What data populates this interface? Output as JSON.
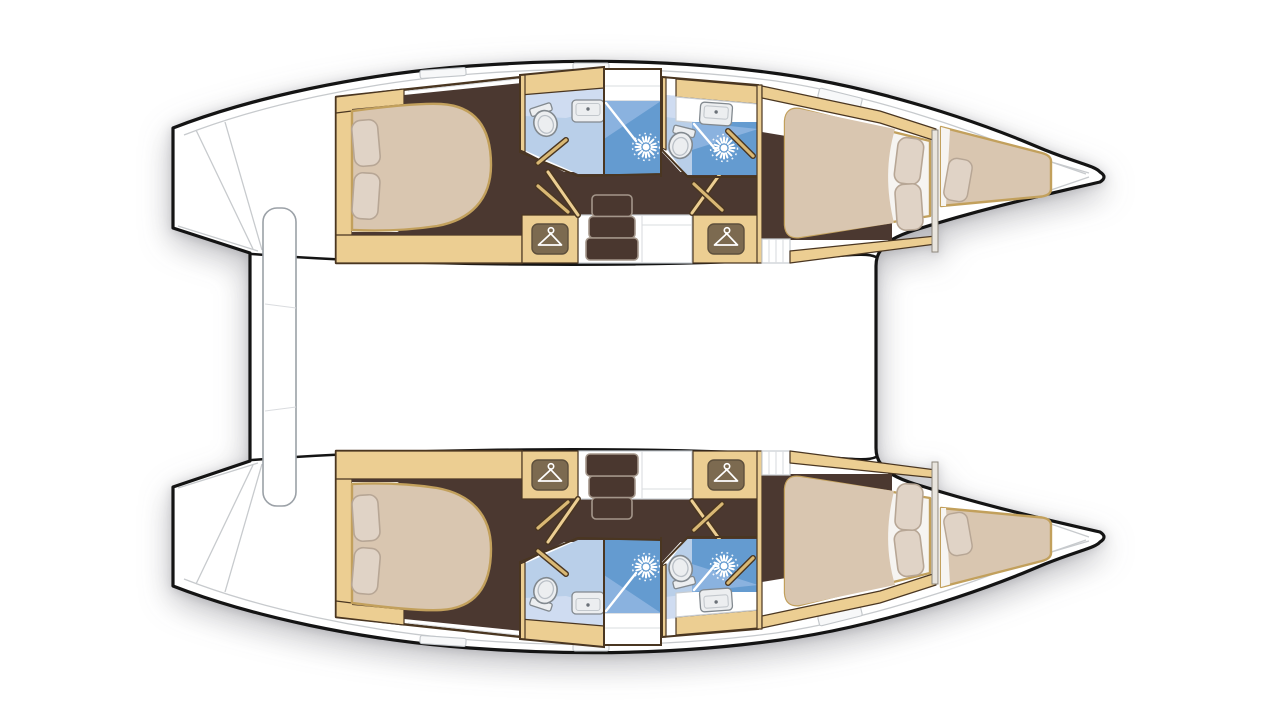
{
  "vessel": {
    "title": "Catamaran interior layout — deck plan, top view",
    "type": "catamaran sailing yacht floor plan",
    "configuration": "4 double cabins, 4 shower rooms, 2 forepeak berths",
    "hull_count": 2,
    "orientation": "bow to the right, boarding steps to the left"
  },
  "hulls": [
    {
      "id": "port-hull",
      "position": "top",
      "sections": [
        {
          "name": "aft cabin",
          "furniture": [
            "island double bed",
            "two pillows",
            "side cabinets"
          ]
        },
        {
          "name": "aft shower room",
          "fixtures": [
            "toilet",
            "washbasin",
            "shower with drain"
          ]
        },
        {
          "name": "forward shower room",
          "fixtures": [
            "toilet",
            "washbasin",
            "shower with drain"
          ]
        },
        {
          "name": "companionway",
          "features": [
            "three-step staircase",
            "two hanging wardrobes"
          ]
        },
        {
          "name": "forward cabin",
          "furniture": [
            "double bed",
            "two pillows",
            "entry steps"
          ]
        },
        {
          "name": "forepeak berth",
          "furniture": [
            "single mattress",
            "one pillow"
          ]
        },
        {
          "name": "transom",
          "features": [
            "boarding steps"
          ]
        }
      ]
    },
    {
      "id": "starboard-hull",
      "position": "bottom",
      "sections": [
        {
          "name": "aft cabin",
          "furniture": [
            "island double bed",
            "two pillows",
            "side cabinets"
          ]
        },
        {
          "name": "aft shower room",
          "fixtures": [
            "toilet",
            "washbasin",
            "shower with drain"
          ]
        },
        {
          "name": "forward shower room",
          "fixtures": [
            "toilet",
            "washbasin",
            "shower with drain"
          ]
        },
        {
          "name": "companionway",
          "features": [
            "three-step staircase",
            "two hanging wardrobes"
          ]
        },
        {
          "name": "forward cabin",
          "furniture": [
            "double bed",
            "two pillows",
            "entry steps"
          ]
        },
        {
          "name": "forepeak berth",
          "furniture": [
            "single mattress",
            "one pillow"
          ]
        },
        {
          "name": "transom",
          "features": [
            "boarding steps"
          ]
        }
      ]
    }
  ],
  "deck": {
    "aft_platform": "cockpit bench between the transoms",
    "bridgedeck": "open white area between the hulls",
    "bow": "anchor locker lines at both bow tips"
  },
  "icons": [
    {
      "name": "hanger-icon",
      "meaning": "hanging wardrobe",
      "count": 4
    },
    {
      "name": "shower-drain-icon",
      "meaning": "shower head / drain",
      "count": 4
    }
  ],
  "palette": {
    "outline": "#141414",
    "deckLine": "#c7cacd",
    "tan": "#ecce92",
    "gold": "#d9b874",
    "wood": "#4a3621",
    "floor": "#4b3830",
    "bed": "#d9c6b0",
    "bedEdge": "#c2a05c",
    "sheet": "#f6f4f1",
    "pillow": "#e0d3c6",
    "pillowLine": "#b7a695",
    "bathFloor": "#b9cfe9",
    "bathLight": "#cfdcf1",
    "shower": "#649bd0",
    "showerLight": "#8ab2df",
    "fixture": "#eceef0",
    "fixtureLine": "#82898f",
    "iconBg": "#7c6a50"
  }
}
